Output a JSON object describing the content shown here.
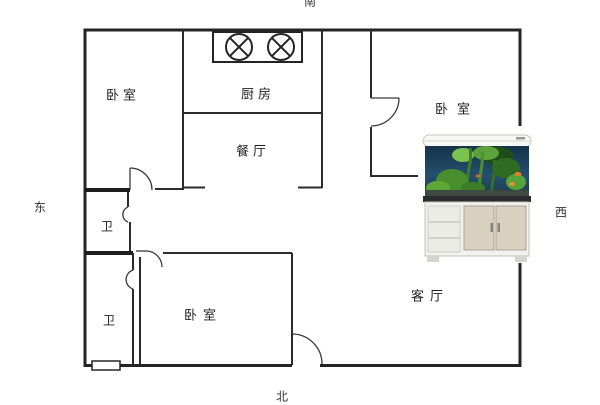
{
  "plan": {
    "type": "apartment-floor-plan",
    "compass": {
      "south": "南",
      "north": "北",
      "east": "东",
      "west": "西"
    },
    "rooms": {
      "bedroom_top_left": "卧室",
      "kitchen": "厨房",
      "dining_room": "餐厅",
      "bedroom_top_right": "卧室",
      "bathroom_upper": "卫",
      "bathroom_lower": "卫",
      "bedroom_bottom": "卧室",
      "living_room": "客厅"
    },
    "fixtures": {
      "stove_burner_count": 2,
      "window_symbol": "window-on-south-bottom-wall",
      "aquarium": "鱼缸"
    },
    "colors": {
      "wall": "#2b2b2b",
      "background": "#ffffff",
      "aquarium_water": "#1d3f5c",
      "aquarium_plants": "#4a8f2e",
      "fish": "#e87f28",
      "cabinet_doors": "#d8d1c0"
    }
  }
}
